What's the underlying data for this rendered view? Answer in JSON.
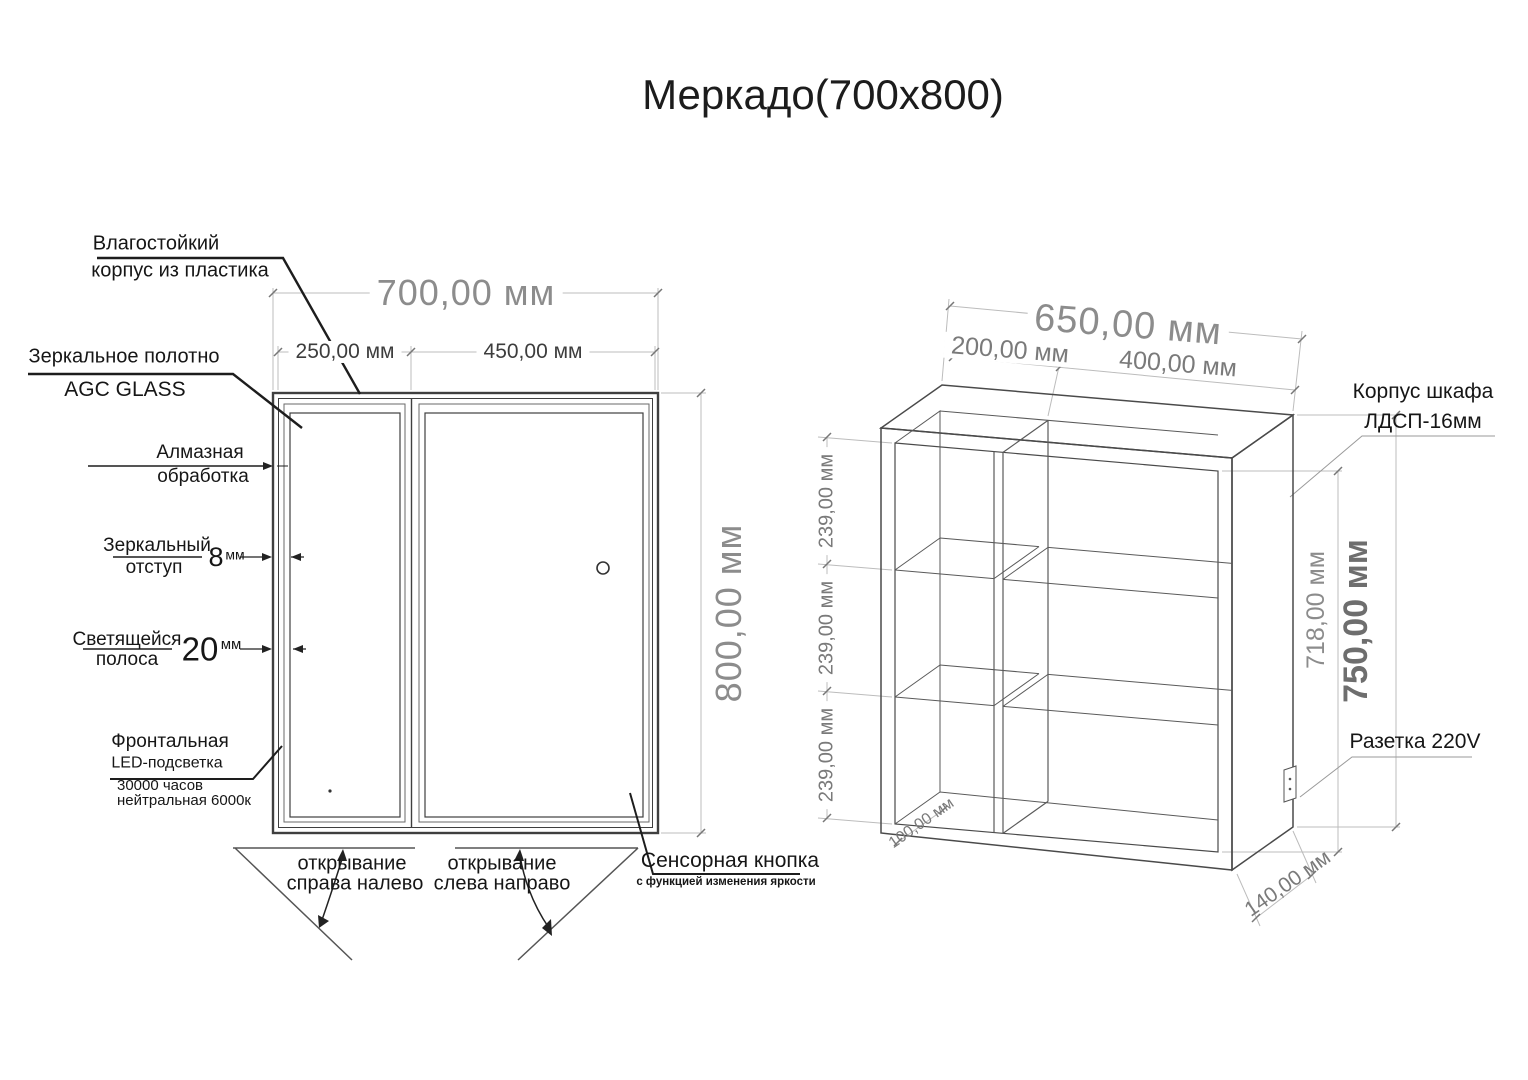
{
  "title": "Меркадо(700х800)",
  "front_view": {
    "dim_width_total": "700,00 мм",
    "dim_width_left": "250,00 мм",
    "dim_width_right": "450,00 мм",
    "dim_height": "800,00 мм",
    "label_waterproof_1": "Влагостойкий",
    "label_waterproof_2": "корпус из пластика",
    "label_mirror_1": "Зеркальное полотно",
    "label_mirror_2": "AGC GLASS",
    "label_diamond_1": "Алмазная",
    "label_diamond_2": "обработка",
    "label_offset_1": "Зеркальный",
    "label_offset_2": "отступ",
    "offset_value": "8",
    "offset_unit": "мм",
    "label_glow_1": "Светящейся",
    "label_glow_2": "полоса",
    "glow_value": "20",
    "glow_unit": "мм",
    "label_led_1": "Фронтальная",
    "label_led_2": "LED-подсветка",
    "label_led_3": "30000 часов",
    "label_led_4": "нейтральная 6000к",
    "label_sensor_1": "Сенсорная кнопка",
    "label_sensor_2": "с функцией изменения яркости",
    "label_open_left_1": "открывание",
    "label_open_left_2": "справа налево",
    "label_open_right_1": "открывание",
    "label_open_right_2": "слева направо"
  },
  "cabinet_view": {
    "dim_width_total": "650,00 мм",
    "dim_width_left": "200,00 мм",
    "dim_width_right": "400,00 мм",
    "dim_shelf_spacing": "239,00 мм",
    "dim_inner_height": "718,00 мм",
    "dim_outer_height": "750,00 мм",
    "dim_bottom_inset": "100,00 мм",
    "dim_depth": "140,00 мм",
    "label_body_1": "Корпус шкафа",
    "label_body_2": "ЛДСП-16мм",
    "label_socket": "Разетка 220V"
  }
}
